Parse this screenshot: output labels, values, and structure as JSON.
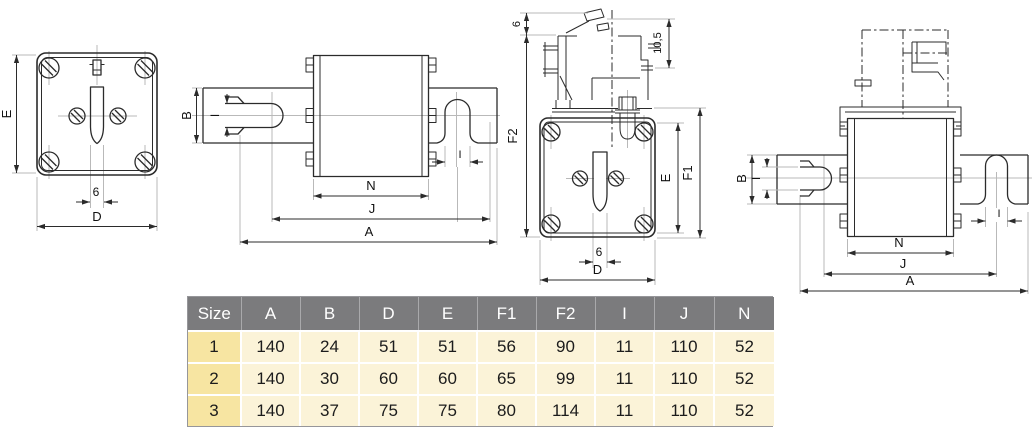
{
  "theme": {
    "canvas-bg": "#ffffff",
    "line": "#2b2b2b",
    "thin-line": "#b9b9b9",
    "dim-text": "#111111",
    "header-bg": "#7b7b7d",
    "header-text": "#ffffff",
    "header-sep": "#a9a9ab",
    "size-col-bg": "#f7e5a2",
    "cell-bg": "#fbf3d8",
    "grid-line": "#ffffff",
    "table-border": "#96969a"
  },
  "views": {
    "front": {
      "E": "E",
      "slot_width": "6",
      "D": "D"
    },
    "side": {
      "B": "B",
      "I": "I",
      "N": "N",
      "J": "J",
      "A": "A",
      "I_right": "I"
    },
    "front_switch": {
      "top_gap": "6",
      "switch_height": "10,5",
      "F2": "F2",
      "E": "E",
      "F1": "F1",
      "slot_width": "6",
      "D": "D"
    },
    "side_switch": {
      "B": "B",
      "I": "I",
      "N": "N",
      "J": "J",
      "A": "A",
      "I_right": "I"
    }
  },
  "table": {
    "header": [
      "Size",
      "A",
      "B",
      "D",
      "E",
      "F1",
      "F2",
      "I",
      "J",
      "N"
    ],
    "rows": [
      [
        "1",
        "140",
        "24",
        "51",
        "51",
        "56",
        "90",
        "11",
        "110",
        "52"
      ],
      [
        "2",
        "140",
        "30",
        "60",
        "60",
        "65",
        "99",
        "11",
        "110",
        "52"
      ],
      [
        "3",
        "140",
        "37",
        "75",
        "75",
        "80",
        "114",
        "11",
        "110",
        "52"
      ]
    ]
  }
}
